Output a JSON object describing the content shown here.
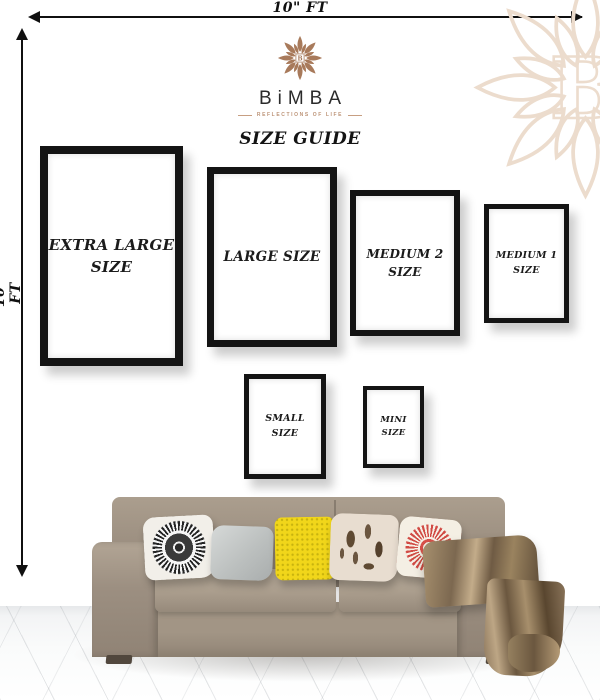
{
  "measurements": {
    "top_label": "10\" FT",
    "left_label": "10\" FT"
  },
  "brand": {
    "name": "BiMBA",
    "tagline": "REFLECTIONS OF LIFE",
    "monogram": "B",
    "accent_color": "#a87a5b",
    "watermark_color": "#ecdccd"
  },
  "title": "SIZE GUIDE",
  "frames": [
    {
      "id": "extra-large",
      "line1": "EXTRA LARGE",
      "line2": "SIZE"
    },
    {
      "id": "large",
      "line1": "LARGE SIZE",
      "line2": ""
    },
    {
      "id": "medium-2",
      "line1": "MEDIUM 2",
      "line2": "SIZE"
    },
    {
      "id": "medium-1",
      "line1": "MEDIUM 1",
      "line2": "SIZE"
    },
    {
      "id": "small",
      "line1": "SMALL",
      "line2": "SIZE"
    },
    {
      "id": "mini",
      "line1": "MINI",
      "line2": "SIZE"
    }
  ],
  "colors": {
    "frame_black": "#141414",
    "text_dark": "#1b1b1b",
    "sofa_taupe": "#9a8d7e",
    "pillow_gray": "#c5c9c8",
    "pillow_yellow": "#f0d916",
    "pillow_red": "#d14b44",
    "pillow_cream": "#e7dccd",
    "throw_bronze": "#8a745a",
    "floor_white": "#f4f5f6"
  }
}
